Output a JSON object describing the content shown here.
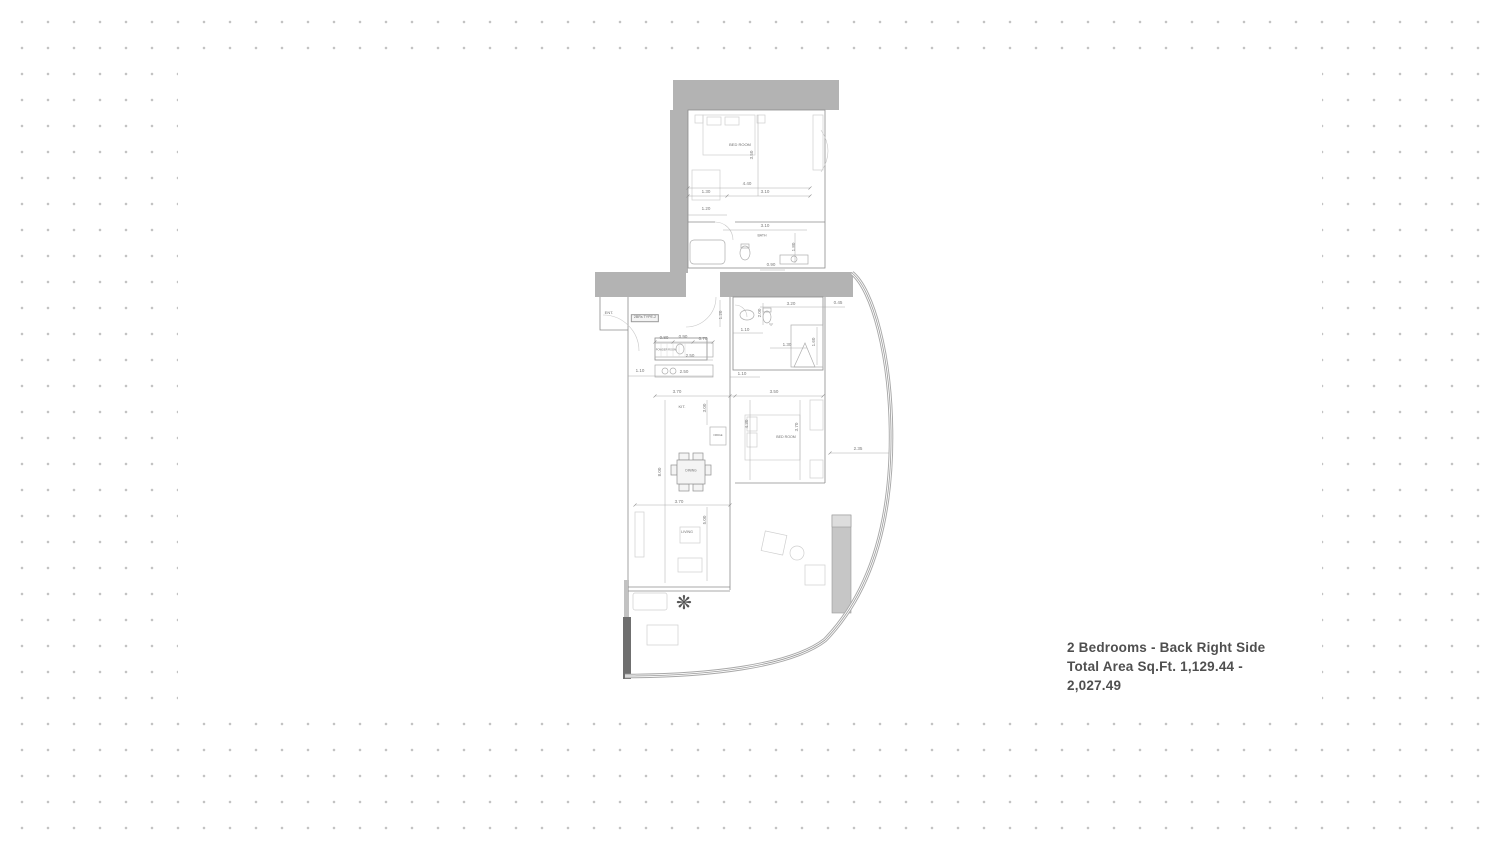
{
  "caption": {
    "line1": "2 Bedrooms - Back Right Side",
    "line2": "Total Area Sq.Ft. 1,129.44 - 2,027.49"
  },
  "plan": {
    "unit_type_label": "2BRs TYPE-2",
    "icons": {
      "plant": "❋"
    },
    "room_labels": [
      {
        "t": "BED ROOM",
        "x": 145,
        "y": 70,
        "s": 4
      },
      {
        "t": "BATH",
        "x": 167,
        "y": 161,
        "s": 3.5
      },
      {
        "t": "ENT.",
        "x": 14,
        "y": 238,
        "s": 4
      },
      {
        "t": "POWDER ROOM",
        "x": 71,
        "y": 276,
        "s": 2.6
      },
      {
        "t": "*S*",
        "x": 176,
        "y": 250,
        "s": 3
      },
      {
        "t": "KIT.",
        "x": 87,
        "y": 332,
        "s": 4
      },
      {
        "t": "FRIDGE",
        "x": 123,
        "y": 361,
        "s": 2.4
      },
      {
        "t": "DINING",
        "x": 96,
        "y": 396,
        "s": 3.2
      },
      {
        "t": "BED ROOM",
        "x": 191,
        "y": 363,
        "s": 3.6
      },
      {
        "t": "LIVING",
        "x": 92,
        "y": 458,
        "s": 3.6
      }
    ],
    "dimension_labels": [
      {
        "t": "4.40",
        "x": 152,
        "y": 109
      },
      {
        "t": "1.30",
        "x": 111,
        "y": 117
      },
      {
        "t": "3.10",
        "x": 170,
        "y": 117
      },
      {
        "t": "3.50",
        "x": 157,
        "y": 80,
        "r": -90
      },
      {
        "t": "1.20",
        "x": 111,
        "y": 134
      },
      {
        "t": "3.10",
        "x": 170,
        "y": 151
      },
      {
        "t": "1.80",
        "x": 199,
        "y": 172,
        "r": -90
      },
      {
        "t": "0.90",
        "x": 176,
        "y": 190
      },
      {
        "t": "3.20",
        "x": 196,
        "y": 229
      },
      {
        "t": "0.45",
        "x": 243,
        "y": 228
      },
      {
        "t": "2.00",
        "x": 165,
        "y": 238,
        "r": -90
      },
      {
        "t": "1.60",
        "x": 219,
        "y": 267,
        "r": -90
      },
      {
        "t": "1.30",
        "x": 192,
        "y": 270
      },
      {
        "t": "1.20",
        "x": 126,
        "y": 240,
        "r": -90
      },
      {
        "t": "1.10",
        "x": 150,
        "y": 255
      },
      {
        "t": "0.80",
        "x": 69,
        "y": 263
      },
      {
        "t": "0.90",
        "x": 88,
        "y": 262
      },
      {
        "t": "0.70",
        "x": 108,
        "y": 264
      },
      {
        "t": "2.50",
        "x": 95,
        "y": 281
      },
      {
        "t": "2.50",
        "x": 89,
        "y": 297
      },
      {
        "t": "1.10",
        "x": 45,
        "y": 296
      },
      {
        "t": "1.10",
        "x": 147,
        "y": 299
      },
      {
        "t": "3.70",
        "x": 82,
        "y": 317
      },
      {
        "t": "3.50",
        "x": 179,
        "y": 317
      },
      {
        "t": "3.00",
        "x": 110,
        "y": 333,
        "r": -90
      },
      {
        "t": "8.00",
        "x": 65,
        "y": 397,
        "r": -90
      },
      {
        "t": "4.30",
        "x": 152,
        "y": 349,
        "r": -90
      },
      {
        "t": "3.70",
        "x": 202,
        "y": 352,
        "r": -90
      },
      {
        "t": "2.35",
        "x": 263,
        "y": 374
      },
      {
        "t": "3.70",
        "x": 84,
        "y": 427
      },
      {
        "t": "5.00",
        "x": 110,
        "y": 445,
        "r": -90
      }
    ]
  }
}
